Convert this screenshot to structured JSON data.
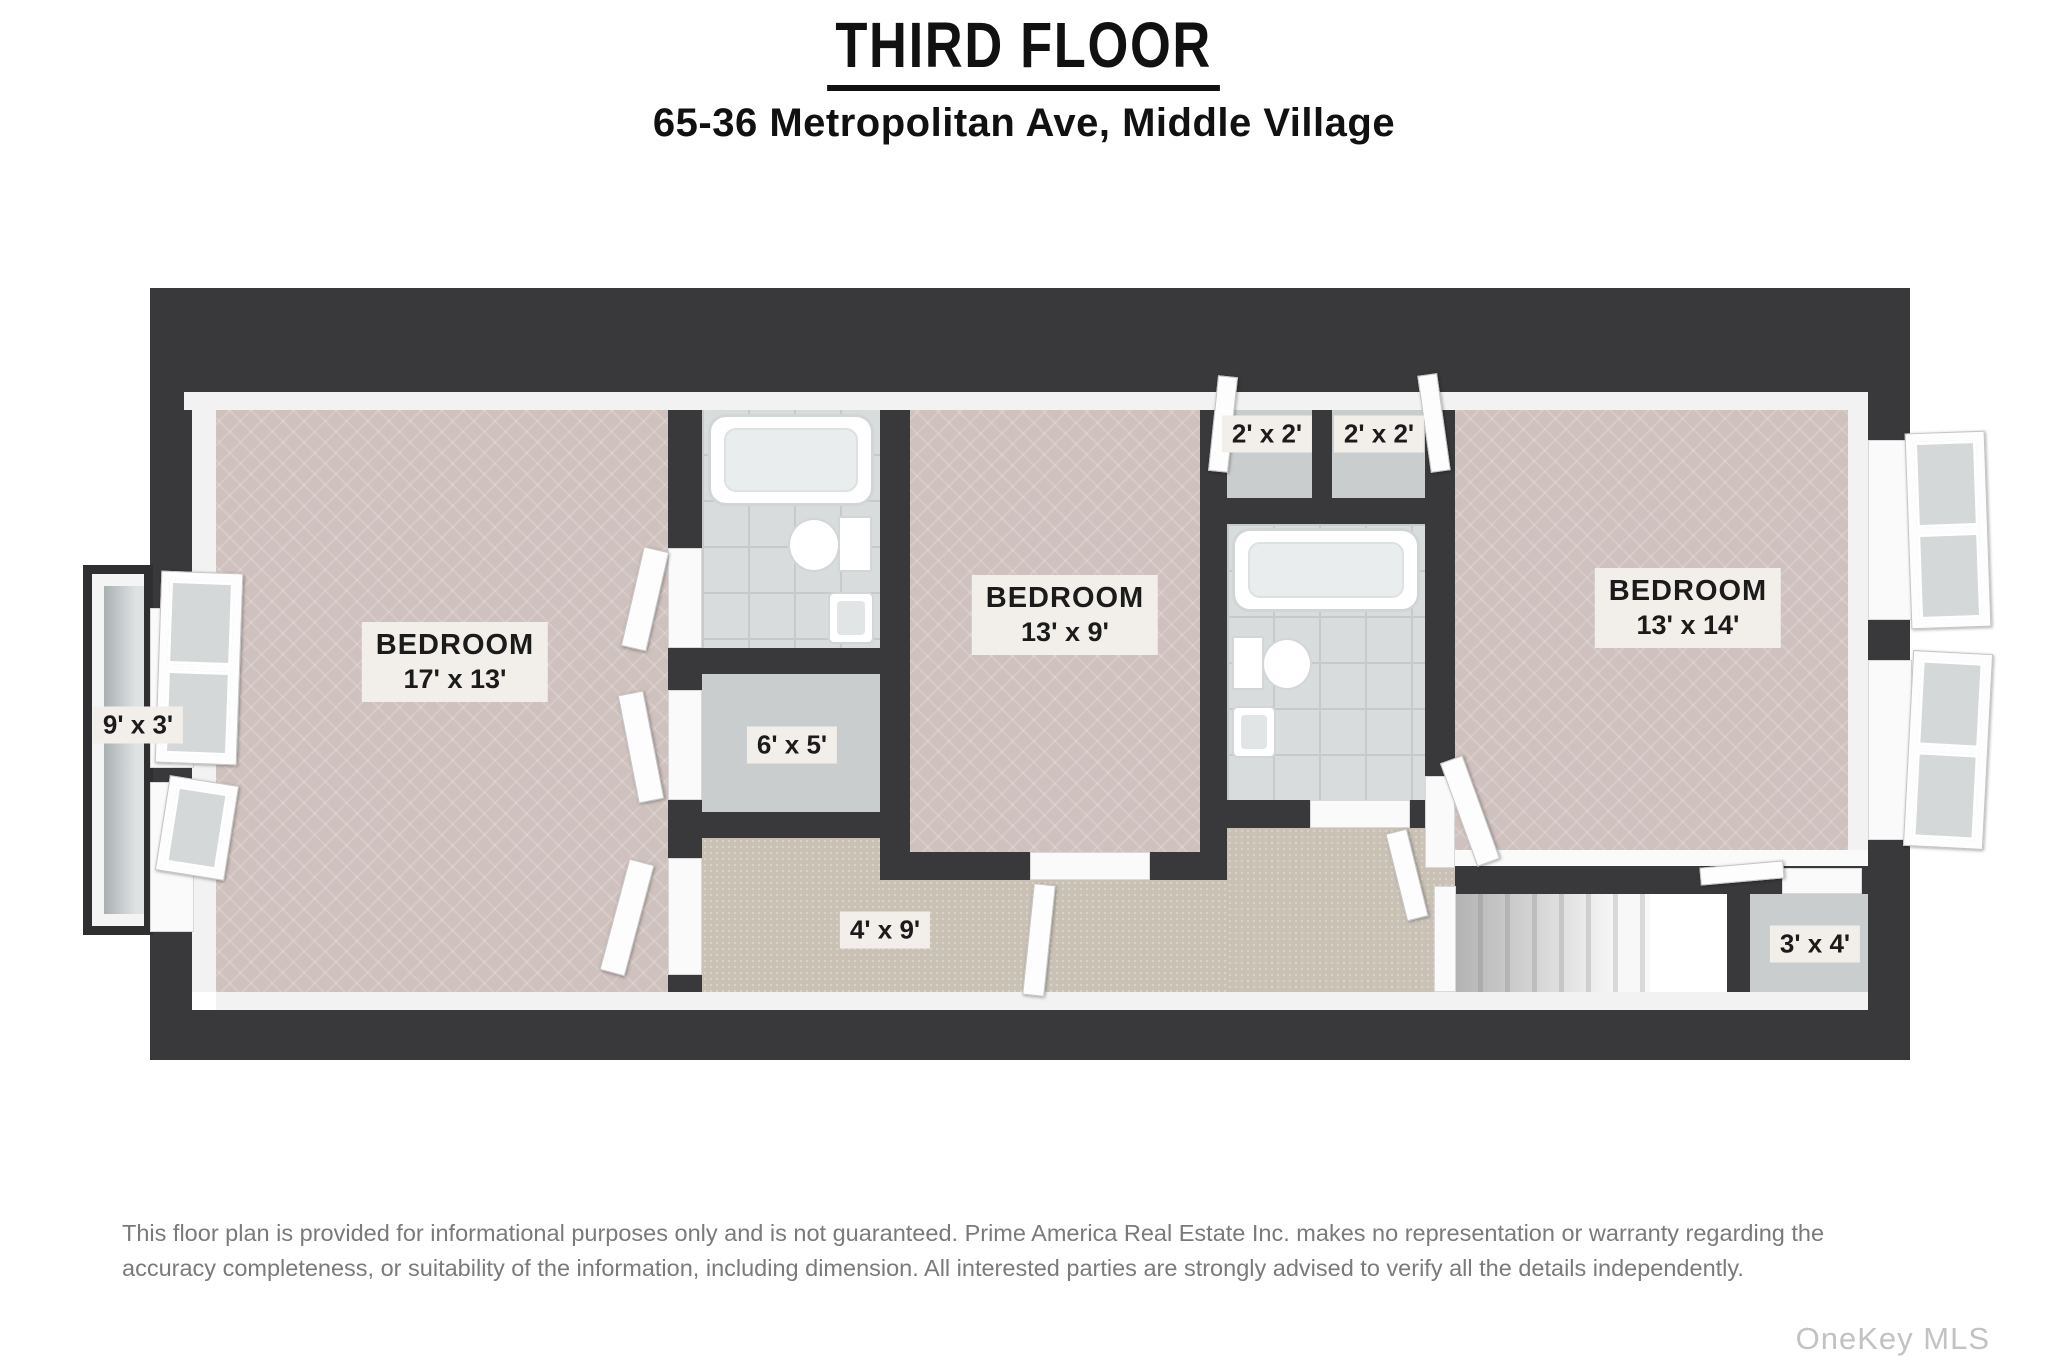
{
  "header": {
    "title": "THIRD FLOOR",
    "address": "65-36 Metropolitan Ave, Middle Village"
  },
  "rooms": {
    "bedroom_left": {
      "name": "BEDROOM",
      "dims": "17' x 13'"
    },
    "bedroom_middle": {
      "name": "BEDROOM",
      "dims": "13' x 9'"
    },
    "bedroom_right": {
      "name": "BEDROOM",
      "dims": "13' x 14'"
    },
    "balcony": {
      "dims": "9' x 3'"
    },
    "closet_middle": {
      "dims": "6' x 5'"
    },
    "hallway": {
      "dims": "4' x 9'"
    },
    "closet_top_left": {
      "dims": "2' x 2'"
    },
    "closet_top_right": {
      "dims": "2' x 2'"
    },
    "closet_bottom_right": {
      "dims": "3' x 4'"
    }
  },
  "footer": {
    "disclaimer": "This floor plan is provided for informational purposes only and is not guaranteed. Prime America Real Estate Inc. makes no representation or warranty regarding the accuracy completeness, or suitability of the information, including dimension. All interested parties are strongly advised to verify all the details independently.",
    "watermark": "OneKey MLS"
  },
  "colors": {
    "wall": "#39383a",
    "bedroom_floor": "#cfc1bd",
    "tile_floor": "#d9dcdd",
    "carpet_floor": "#c9c1b4",
    "closet_floor": "#c9cdce",
    "balcony_floor": "#aab0b2",
    "label_bg": "#f2eeea",
    "label_text": "#1b1b1b",
    "accent_dark": "#111111",
    "disclaimer_text": "#7a7a7a",
    "watermark_text": "#c2c2c2"
  }
}
